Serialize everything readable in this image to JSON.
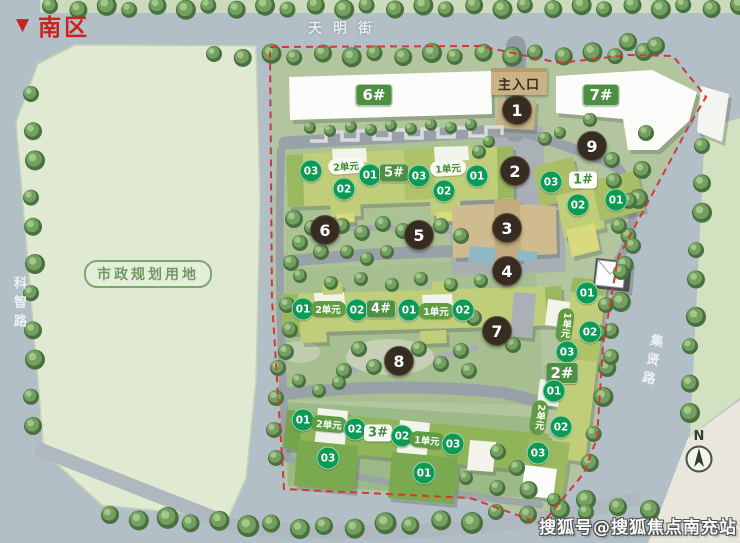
{
  "title": {
    "arrow": "▼",
    "text": "南区"
  },
  "streets": {
    "top": "天明街",
    "left": "科智路",
    "right": "集贤路"
  },
  "parcel": {
    "label": "市政规划用地"
  },
  "entrance": {
    "label": "主入口"
  },
  "compass": {
    "label": "N"
  },
  "watermark": {
    "text": "搜狐号@搜狐焦点南充站"
  },
  "markers": [
    "1",
    "2",
    "3",
    "4",
    "5",
    "6",
    "7",
    "8",
    "9"
  ],
  "chips": [
    "6#",
    "7#",
    "03",
    "2单元",
    "02",
    "01",
    "5#",
    "03",
    "1单元",
    "02",
    "01",
    "03",
    "1#",
    "02",
    "01",
    "01",
    "2单元",
    "02",
    "4#",
    "01",
    "1单元",
    "02",
    "01",
    "2单元",
    "02",
    "3#",
    "02",
    "1单元",
    "03",
    "03",
    "01",
    "01",
    "1单元",
    "02",
    "03",
    "2#",
    "01",
    "2单元",
    "02",
    "03"
  ],
  "colors": {
    "boundary_red": "#d23a2e",
    "marker_bg": "#362c22",
    "unit_green": "#0d9a53",
    "building_label_green": "#4d9044",
    "title_red": "#c8231d",
    "building_body": "#c0cd79",
    "parcel_green": "#e0ead3",
    "road_gray": "#b3bfc7"
  }
}
